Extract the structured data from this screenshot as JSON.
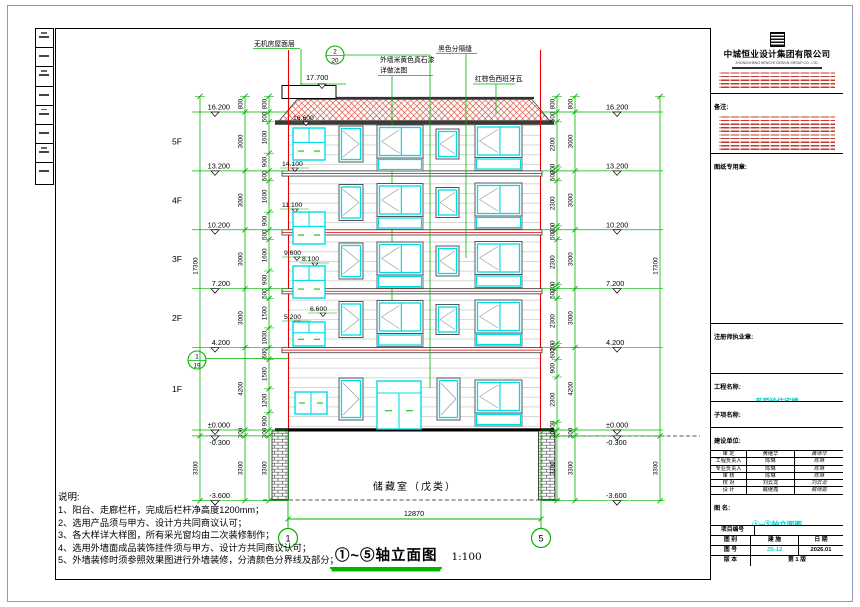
{
  "company": {
    "name": "中城恒业设计集团有限公司",
    "english": "ZHONGCHENG HENGYE DESIGN GROUP CO., LTD."
  },
  "titleblock": {
    "remark_label": "备注:",
    "stamp_label": "图纸专用章:",
    "license_label": "注册师执业章:",
    "project_label": "工程名称:",
    "project_value": "苏爱玲住宅楼",
    "subitem_label": "子项名称:",
    "client_label": "建设单位:",
    "client_value": "苏爱玲",
    "figname_label": "图  名:",
    "figname_value": "①~⑤轴立面图",
    "projno_label": "项目编号",
    "type_label": "图  别",
    "type_value": "建  施",
    "date_label": "日  期",
    "no_label": "图  号",
    "no_value": "JS-12",
    "date_value": "2026.01",
    "ver_label": "版  本",
    "ver_value": "第 1 版",
    "signatures": [
      {
        "role": "审  定",
        "name": "黄继华",
        "sign": "黄继华"
      },
      {
        "role": "工程负责人",
        "name": "陈琳",
        "sign": "陈琳"
      },
      {
        "role": "专业负责人",
        "name": "陈琳",
        "sign": "陈琳"
      },
      {
        "role": "审  核",
        "name": "陈琳",
        "sign": "陈琳"
      },
      {
        "role": "校  对",
        "name": "刘云龙",
        "sign": "刘云龙"
      },
      {
        "role": "设  计",
        "name": "戴继霞",
        "sign": "戴继霞"
      }
    ]
  },
  "notes": {
    "title": "说明:",
    "items": [
      "1、阳台、走廊栏杆，完成后栏杆净高度1200mm；",
      "2、选用产品须与甲方、设计方共同商议认可；",
      "3、各大样详大样图，所有采光窗均由二次装修制作；",
      "4、选用外墙面成品装饰挂件须与甲方、设计方共同商议认可；",
      "5、外墙装修时须参照效果图进行外墙装修，分清颜色分界线及部分；"
    ]
  },
  "drawing": {
    "title": "①~⑤轴立面图",
    "scale": "1:100",
    "storage_room": "储藏室（戊类）",
    "span_dim": "12870",
    "axis_left": "1",
    "axis_right": "5",
    "roof_level": "17.700",
    "levels": [
      "16.200",
      "13.200",
      "10.200",
      "7.200",
      "4.200",
      "±0.000",
      "-0.300",
      "-3.600"
    ],
    "floor_labels": [
      "5F",
      "4F",
      "3F",
      "2F",
      "1F"
    ],
    "interior_levels": [
      "16.600",
      "14.100",
      "11.100",
      "9.600",
      "8.100",
      "6.600",
      "5.200"
    ],
    "annotations": {
      "machine_roof": "无机房屋面层",
      "wall_paint": "外墙米黄色真石漆",
      "wall_paint2": "详做法图",
      "black_joint": "黑色分隔缝",
      "roof_tile": "红棕色西班牙瓦"
    },
    "detail_bubbles": [
      {
        "num": "2",
        "sheet": "20"
      },
      {
        "num": "1",
        "sheet": "19"
      }
    ],
    "dims": {
      "left_overall": [
        "17300",
        "3300"
      ],
      "left_storey": [
        "800",
        "3000",
        "3000",
        "3000",
        "3000",
        "4200",
        "300",
        "3300"
      ],
      "left_detail": [
        "800",
        "500",
        "1600",
        "900",
        "500",
        "1600",
        "900",
        "500",
        "1600",
        "900",
        "500",
        "1500",
        "1000",
        "600",
        "1500",
        "1200",
        "900",
        "300",
        "3300"
      ],
      "right_detail": [
        "800",
        "500",
        "2300",
        "200",
        "500",
        "2300",
        "200",
        "500",
        "2300",
        "200",
        "500",
        "2300",
        "200",
        "600",
        "900",
        "2300",
        "400",
        "300",
        "3300"
      ],
      "right_storey": [
        "800",
        "3000",
        "3000",
        "3000",
        "3000",
        "4200",
        "300",
        "3300"
      ],
      "right_overall": [
        "17300",
        "3300"
      ]
    }
  },
  "colors": {
    "green": "#00b400",
    "red": "#e60000",
    "cyan": "#00dde6",
    "tb_cyan": "#00cfcf"
  }
}
